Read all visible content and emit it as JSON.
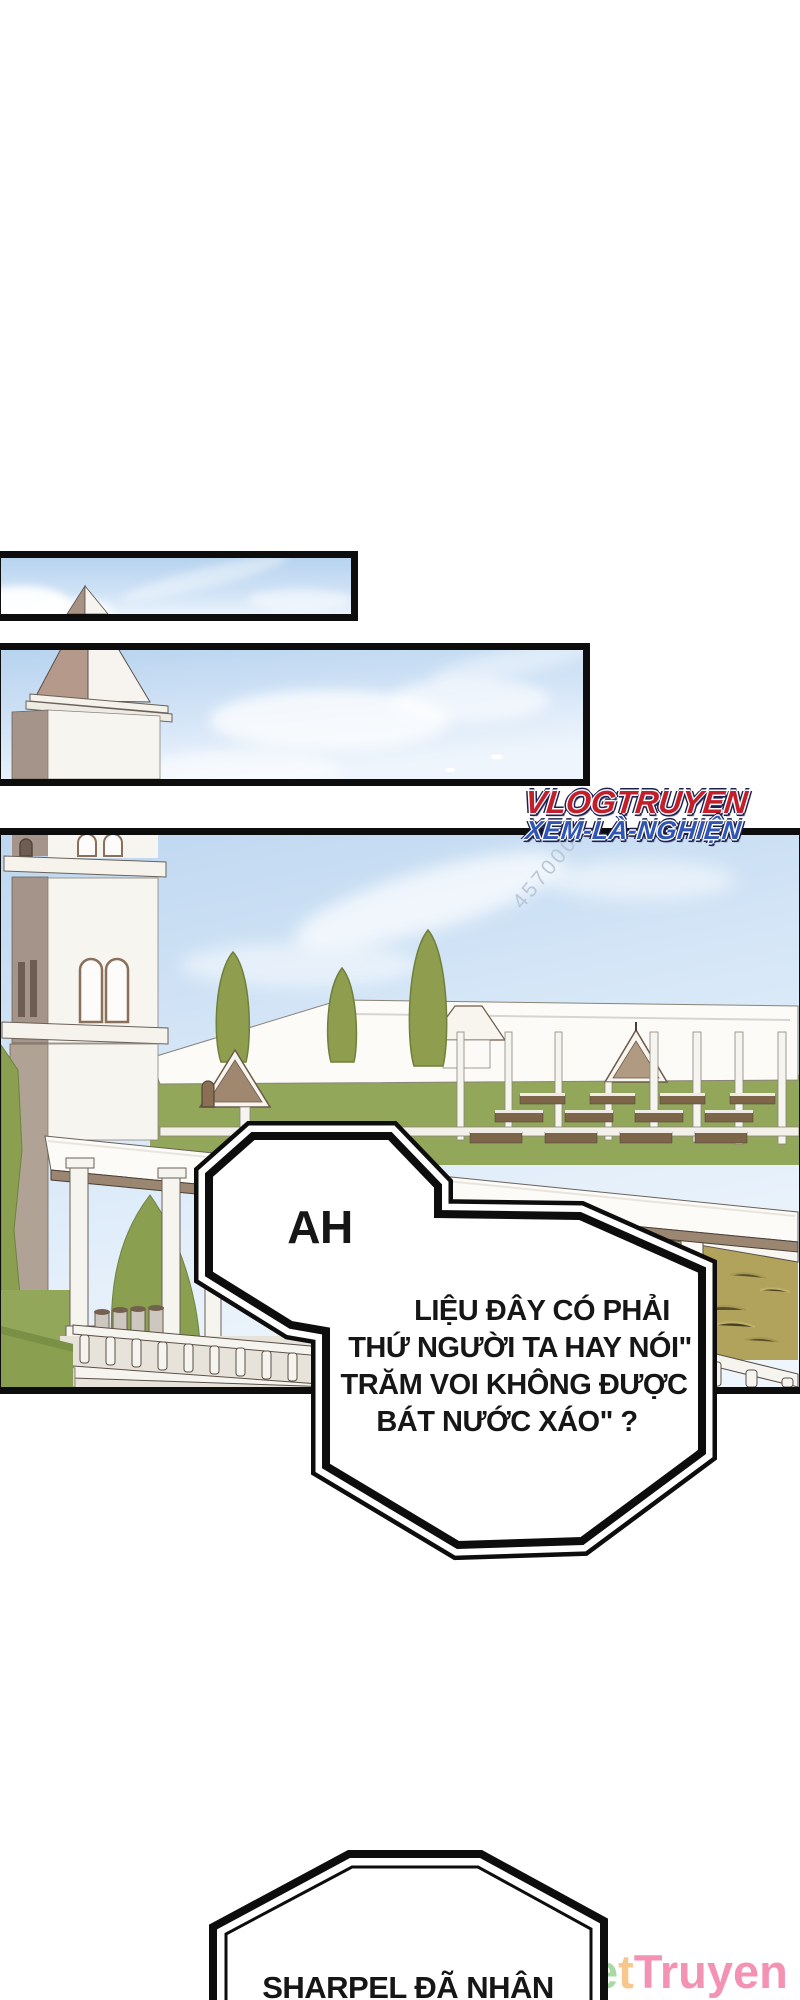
{
  "page": {
    "width": 800,
    "height": 2000,
    "background": "#ffffff",
    "kind": "webtoon-comic-page"
  },
  "watermarks": {
    "site_top": {
      "line1": "VLOGTRUYEN",
      "line2": "XEM-LÀ-NGHIỆN",
      "line1_color": "#c21f2b",
      "line2_color": "#3056b5",
      "outline_color": "#1c2050"
    },
    "number_mark": "457000",
    "site_bottom": {
      "text": "NetTruyen",
      "letters": [
        {
          "ch": "N",
          "color": "#85c6ea"
        },
        {
          "ch": "e",
          "color": "#a8d9a3"
        },
        {
          "ch": "t",
          "color": "#f7c78e"
        },
        {
          "ch": "T",
          "color": "#f492b4"
        },
        {
          "ch": "r",
          "color": "#f492b4"
        },
        {
          "ch": "u",
          "color": "#f492b4"
        },
        {
          "ch": "y",
          "color": "#f492b4"
        },
        {
          "ch": "e",
          "color": "#f492b4"
        },
        {
          "ch": "n",
          "color": "#f492b4"
        }
      ]
    }
  },
  "speech": {
    "ah": "AH",
    "main": {
      "line1": "LIỆU ĐÂY CÓ PHẢI",
      "line2": "THỨ NGƯỜI TA HAY NÓI\"",
      "line3": "TRĂM VOI KHÔNG ĐƯỢC",
      "line4": "BÁT NƯỚC XÁO\" ?"
    },
    "bottom": "SHARPEL ĐÃ NHÂN"
  },
  "scene": {
    "panels": [
      {
        "id": 1,
        "content": "narrow sky strip with spire tip"
      },
      {
        "id": 2,
        "content": "sky with church tower spire"
      },
      {
        "id": 3,
        "content": "campus courtyard: tower, long roofs, trees, benches, tan field, balustrades"
      }
    ],
    "palette": {
      "panel_border": "#0d0d0d",
      "sky_top": "#b7d3ee",
      "sky_light": "#eef5fc",
      "tree_olive": "#8f9e4e",
      "grass": "#93a75a",
      "lawn": "#8aa050",
      "field_tan": "#b2a35c",
      "roof_white": "#fcfbf8",
      "wood_fascia": "#9b8672",
      "tower_shadow": "#a5948a",
      "spire_brown": "#b59a8c",
      "outline": "#5a5048"
    }
  }
}
